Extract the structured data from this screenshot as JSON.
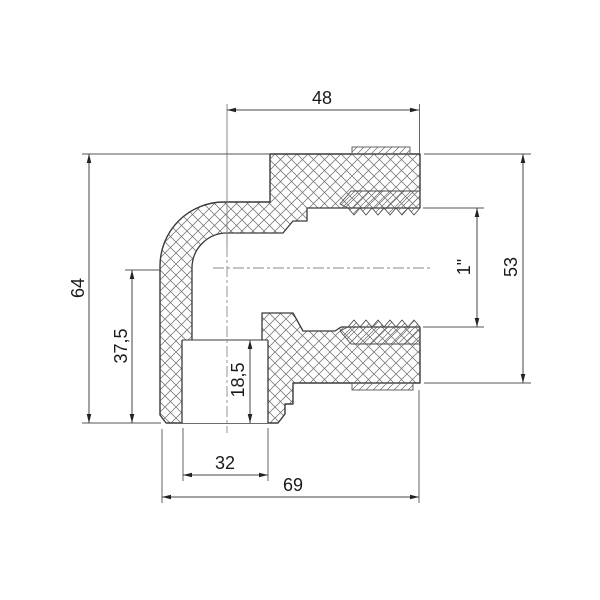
{
  "drawing": {
    "type": "technical-section-drawing",
    "subject": "pipe-elbow-fitting-with-threaded-socket",
    "colors": {
      "background": "#ffffff",
      "outline": "#3a3a3a",
      "hatch": "#6e6e6e",
      "dimension_lines": "#444444",
      "centerline": "#8a8a8a",
      "text": "#1a1a1a"
    },
    "dimensions": {
      "socket_length": {
        "label": "48"
      },
      "outer_diameter": {
        "label": "53"
      },
      "thread_size": {
        "label": "1\""
      },
      "total_height": {
        "label": "64"
      },
      "body_height": {
        "label": "37,5"
      },
      "socket_depth": {
        "label": "18,5"
      },
      "spigot_bore": {
        "label": "32"
      },
      "total_width": {
        "label": "69"
      }
    }
  }
}
